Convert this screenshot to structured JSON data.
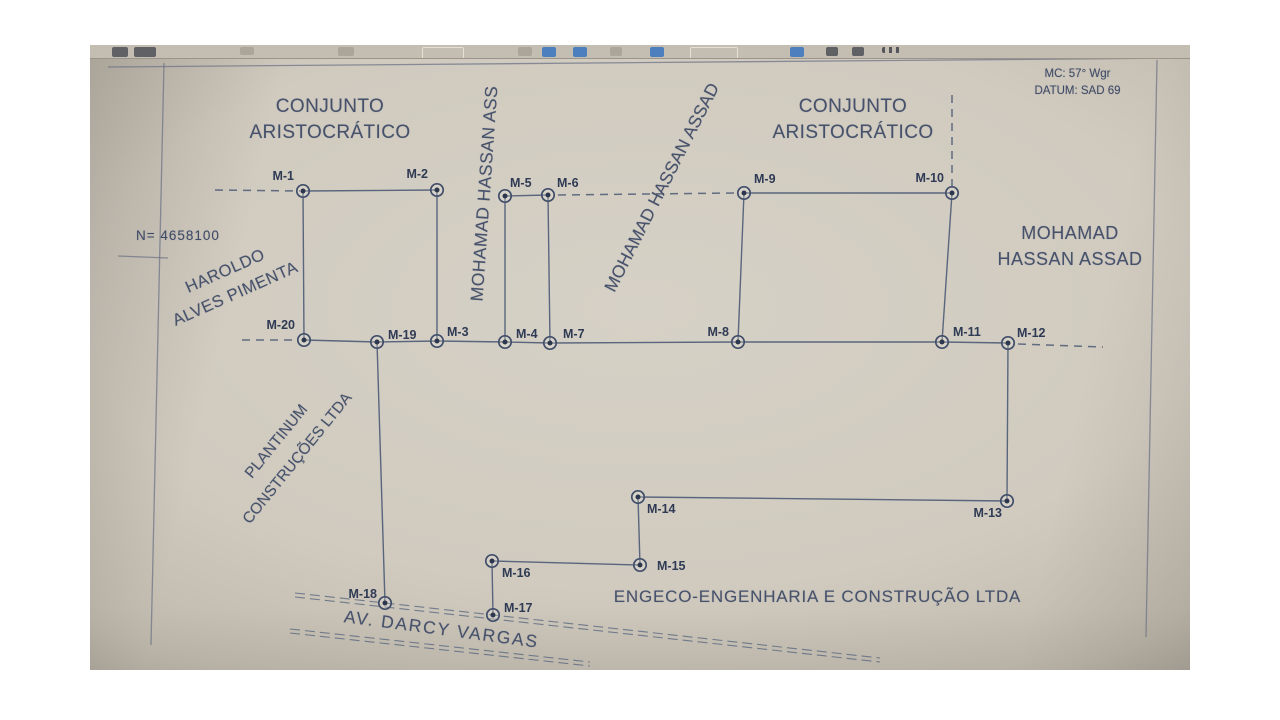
{
  "colors": {
    "line": "#4d5b76",
    "frame": "#6f7587",
    "text": "#46516b",
    "marker_label": "#2f3a54",
    "photo_background": "#d6d1c6",
    "toolbar_blue": "#4d7fbe",
    "toolbar_dark": "#55565c"
  },
  "map_info": {
    "mc_label": "MC: 57° Wgr",
    "datum_label": "DATUM: SAD 69"
  },
  "areas": {
    "conjunto_left": {
      "line1": "CONJUNTO",
      "line2": "ARISTOCRÁTICO"
    },
    "conjunto_right": {
      "line1": "CONJUNTO",
      "line2": "ARISTOCRÁTICO"
    },
    "mohamad_vertical": "MOHAMAD HASSAN ASS",
    "mohamad_diagonal": "MOHAMAD HASSAN ASSAD",
    "mohamad_right": {
      "line1": "MOHAMAD",
      "line2": "HASSAN ASSAD"
    },
    "haroldo": {
      "line1": "HAROLDO",
      "line2": "ALVES PIMENTA"
    },
    "plantinum": {
      "line1": "PLANTINUM",
      "line2": "CONSTRUÇÕES LTDA"
    },
    "engeco": "ENGECO-ENGENHARIA E CONSTRUÇÃO LTDA",
    "av_darcy": "AV. DARCY VARGAS",
    "n_coord": "N= 4658100"
  },
  "toolbar": {
    "icons": [
      {
        "x": 22,
        "w": 16,
        "h": 10,
        "type": "solid",
        "color": "#55565c"
      },
      {
        "x": 44,
        "w": 22,
        "h": 10,
        "type": "solid",
        "color": "#55565c"
      },
      {
        "x": 150,
        "w": 14,
        "h": 8,
        "type": "faint",
        "color": "#8e887c"
      },
      {
        "x": 248,
        "w": 16,
        "h": 9,
        "type": "faint",
        "color": "#8e887c"
      },
      {
        "x": 332,
        "w": 40,
        "h": 11,
        "type": "box",
        "color": "#e6e0d4"
      },
      {
        "x": 428,
        "w": 14,
        "h": 9,
        "type": "faint",
        "color": "#8e887c"
      },
      {
        "x": 452,
        "w": 14,
        "h": 10,
        "type": "blue",
        "color": "#4d7fbe"
      },
      {
        "x": 483,
        "w": 14,
        "h": 10,
        "type": "blue",
        "color": "#4d7fbe"
      },
      {
        "x": 520,
        "w": 12,
        "h": 9,
        "type": "faint",
        "color": "#8e887c"
      },
      {
        "x": 560,
        "w": 14,
        "h": 10,
        "type": "blue",
        "color": "#4d7fbe"
      },
      {
        "x": 600,
        "w": 46,
        "h": 11,
        "type": "box",
        "color": "#e6e0d4"
      },
      {
        "x": 700,
        "w": 14,
        "h": 10,
        "type": "blue",
        "color": "#4d7fbe"
      },
      {
        "x": 736,
        "w": 12,
        "h": 9,
        "type": "solid",
        "color": "#55565c"
      },
      {
        "x": 762,
        "w": 12,
        "h": 9,
        "type": "solid",
        "color": "#55565c"
      },
      {
        "x": 792,
        "w": 18,
        "h": 6,
        "type": "dots",
        "color": "#55565c"
      }
    ]
  },
  "diagram": {
    "frame": [
      [
        18,
        22,
        1100,
        13
      ],
      [
        74,
        18,
        61,
        600
      ],
      [
        1067,
        15,
        1056,
        592
      ],
      [
        28,
        211,
        78,
        213
      ]
    ],
    "solid": [
      [
        213,
        146,
        347,
        145
      ],
      [
        415,
        151,
        458,
        150
      ],
      [
        654,
        148,
        862,
        148
      ],
      [
        213,
        146,
        214,
        295
      ],
      [
        347,
        145,
        347,
        296
      ],
      [
        415,
        151,
        415,
        297
      ],
      [
        458,
        150,
        460,
        298
      ],
      [
        654,
        148,
        648,
        297
      ],
      [
        862,
        148,
        852,
        297
      ],
      [
        214,
        295,
        287,
        297
      ],
      [
        287,
        297,
        347,
        296
      ],
      [
        347,
        296,
        415,
        297
      ],
      [
        415,
        297,
        460,
        298
      ],
      [
        460,
        298,
        648,
        297
      ],
      [
        648,
        297,
        852,
        297
      ],
      [
        852,
        297,
        918,
        298
      ],
      [
        918,
        298,
        917,
        456
      ],
      [
        917,
        456,
        548,
        452
      ],
      [
        548,
        452,
        550,
        520
      ],
      [
        550,
        520,
        402,
        516
      ],
      [
        402,
        516,
        403,
        570
      ],
      [
        287,
        297,
        295,
        558
      ]
    ],
    "dashed": [
      [
        125,
        145,
        210,
        146
      ],
      [
        468,
        150,
        645,
        148
      ],
      [
        862,
        50,
        862,
        143
      ],
      [
        152,
        295,
        205,
        295
      ],
      [
        928,
        299,
        1013,
        302
      ]
    ],
    "street": [
      [
        205,
        548,
        790,
        613
      ],
      [
        205,
        552,
        790,
        617
      ],
      [
        200,
        584,
        500,
        617
      ],
      [
        200,
        588,
        500,
        621
      ]
    ],
    "markers": [
      {
        "id": "M-1",
        "x": 213,
        "y": 146,
        "label_x": 204,
        "label_y": 135,
        "anchor": "end"
      },
      {
        "id": "M-2",
        "x": 347,
        "y": 145,
        "label_x": 338,
        "label_y": 133,
        "anchor": "end"
      },
      {
        "id": "M-5",
        "x": 415,
        "y": 151,
        "label_x": 420,
        "label_y": 142,
        "anchor": "start"
      },
      {
        "id": "M-6",
        "x": 458,
        "y": 150,
        "label_x": 467,
        "label_y": 142,
        "anchor": "start"
      },
      {
        "id": "M-9",
        "x": 654,
        "y": 148,
        "label_x": 664,
        "label_y": 138,
        "anchor": "start"
      },
      {
        "id": "M-10",
        "x": 862,
        "y": 148,
        "label_x": 854,
        "label_y": 137,
        "anchor": "end"
      },
      {
        "id": "M-20",
        "x": 214,
        "y": 295,
        "label_x": 205,
        "label_y": 284,
        "anchor": "end"
      },
      {
        "id": "M-19",
        "x": 287,
        "y": 297,
        "label_x": 298,
        "label_y": 294,
        "anchor": "start"
      },
      {
        "id": "M-3",
        "x": 347,
        "y": 296,
        "label_x": 357,
        "label_y": 291,
        "anchor": "start"
      },
      {
        "id": "M-4",
        "x": 415,
        "y": 297,
        "label_x": 426,
        "label_y": 293,
        "anchor": "start"
      },
      {
        "id": "M-7",
        "x": 460,
        "y": 298,
        "label_x": 473,
        "label_y": 293,
        "anchor": "start"
      },
      {
        "id": "M-8",
        "x": 648,
        "y": 297,
        "label_x": 639,
        "label_y": 291,
        "anchor": "end"
      },
      {
        "id": "M-11",
        "x": 852,
        "y": 297,
        "label_x": 863,
        "label_y": 291,
        "anchor": "start"
      },
      {
        "id": "M-12",
        "x": 918,
        "y": 298,
        "label_x": 927,
        "label_y": 292,
        "anchor": "start"
      },
      {
        "id": "M-13",
        "x": 917,
        "y": 456,
        "label_x": 912,
        "label_y": 472,
        "anchor": "end"
      },
      {
        "id": "M-14",
        "x": 548,
        "y": 452,
        "label_x": 557,
        "label_y": 468,
        "anchor": "start"
      },
      {
        "id": "M-15",
        "x": 550,
        "y": 520,
        "label_x": 567,
        "label_y": 525,
        "anchor": "start"
      },
      {
        "id": "M-16",
        "x": 402,
        "y": 516,
        "label_x": 412,
        "label_y": 532,
        "anchor": "start"
      },
      {
        "id": "M-17",
        "x": 403,
        "y": 570,
        "label_x": 414,
        "label_y": 567,
        "anchor": "start"
      },
      {
        "id": "M-18",
        "x": 295,
        "y": 558,
        "label_x": 287,
        "label_y": 553,
        "anchor": "end"
      }
    ]
  }
}
